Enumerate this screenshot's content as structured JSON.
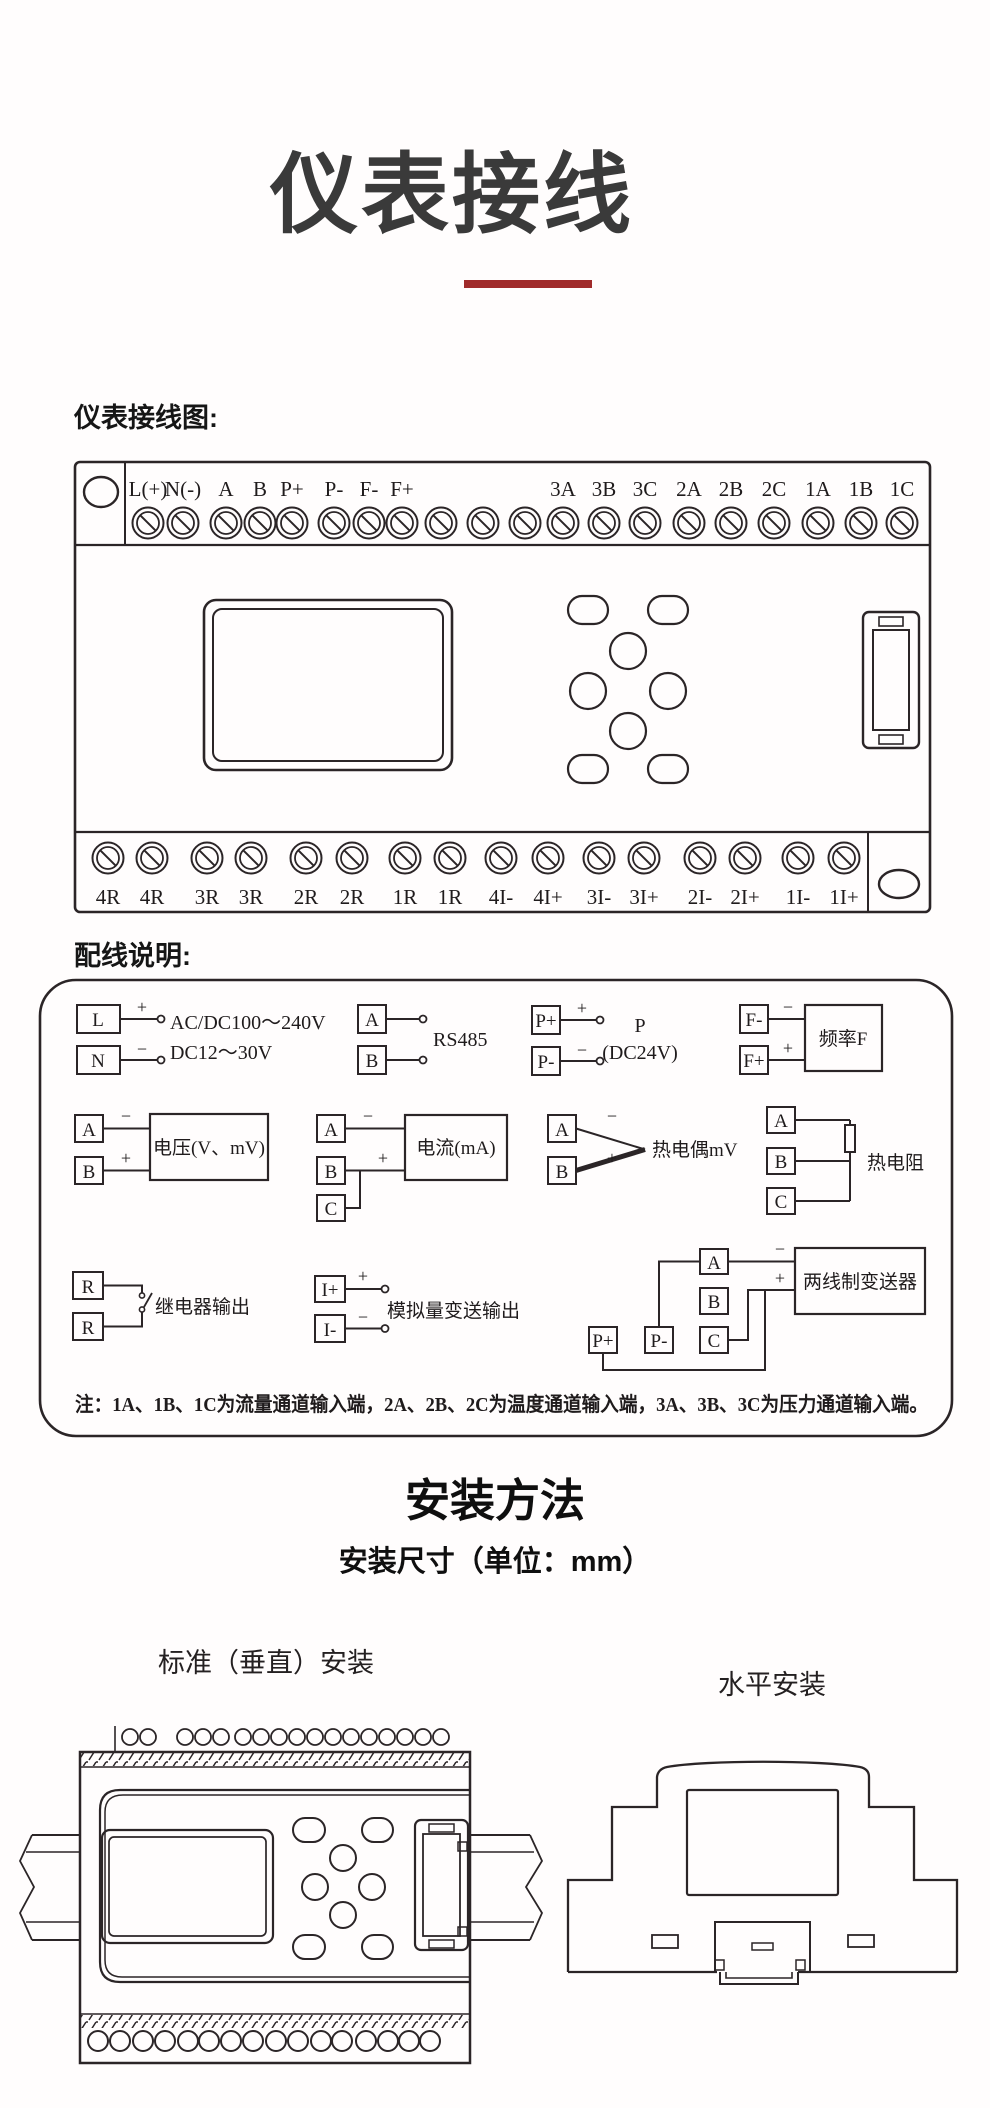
{
  "page": {
    "title": "仪表接线",
    "accent_red": "#a02b2b",
    "line_ink": "#2b2527"
  },
  "wiring": {
    "section_label": "仪表接线图:",
    "top_terminals": [
      "L(+)",
      "N(-)",
      "A",
      "B",
      "P+",
      "P-",
      "F-",
      "F+",
      "3A",
      "3B",
      "3C",
      "2A",
      "2B",
      "2C",
      "1A",
      "1B",
      "1C"
    ],
    "bottom_terminals": [
      "4R",
      "4R",
      "3R",
      "3R",
      "2R",
      "2R",
      "1R",
      "1R",
      "4I-",
      "4I+",
      "3I-",
      "3I+",
      "2I-",
      "2I+",
      "1I-",
      "1I+"
    ]
  },
  "instructions": {
    "section_label": "配线说明:",
    "symbols": {
      "plus": "+",
      "minus": "−"
    },
    "power": {
      "t1": "L",
      "t2": "N",
      "line1": "AC/DC100～240V",
      "line2": "DC12～30V"
    },
    "rs485": {
      "t1": "A",
      "t2": "B",
      "caption": "RS485"
    },
    "sensor_supply": {
      "t1": "P+",
      "t2": "P-",
      "line1": "P",
      "line2": "(DC24V)"
    },
    "frequency": {
      "t1": "F-",
      "t2": "F+",
      "caption": "频率F"
    },
    "voltage": {
      "t1": "A",
      "t2": "B",
      "caption": "电压(V、mV)"
    },
    "current": {
      "t1": "A",
      "t2": "B",
      "t3": "C",
      "caption": "电流(mA)"
    },
    "thermocouple": {
      "t1": "A",
      "t2": "B",
      "caption": "热电偶mV"
    },
    "rtd": {
      "t1": "A",
      "t2": "B",
      "t3": "C",
      "caption": "热电阻"
    },
    "relay": {
      "t1": "R",
      "t2": "R",
      "caption": "继电器输出"
    },
    "analog_output": {
      "t1": "I+",
      "t2": "I-",
      "caption": "模拟量变送输出"
    },
    "transmitter": {
      "t1": "P+",
      "t2": "P-",
      "t3": "A",
      "t4": "B",
      "t5": "C",
      "caption": "两线制变送器"
    },
    "note": "注：1A、1B、1C为流量通道输入端，2A、2B、2C为温度通道输入端，3A、3B、3C为压力通道输入端。"
  },
  "installation": {
    "title": "安装方法",
    "subtitle": "安装尺寸（单位：mm）",
    "vertical_label": "标准（垂直）安装",
    "horizontal_label": "水平安装"
  }
}
